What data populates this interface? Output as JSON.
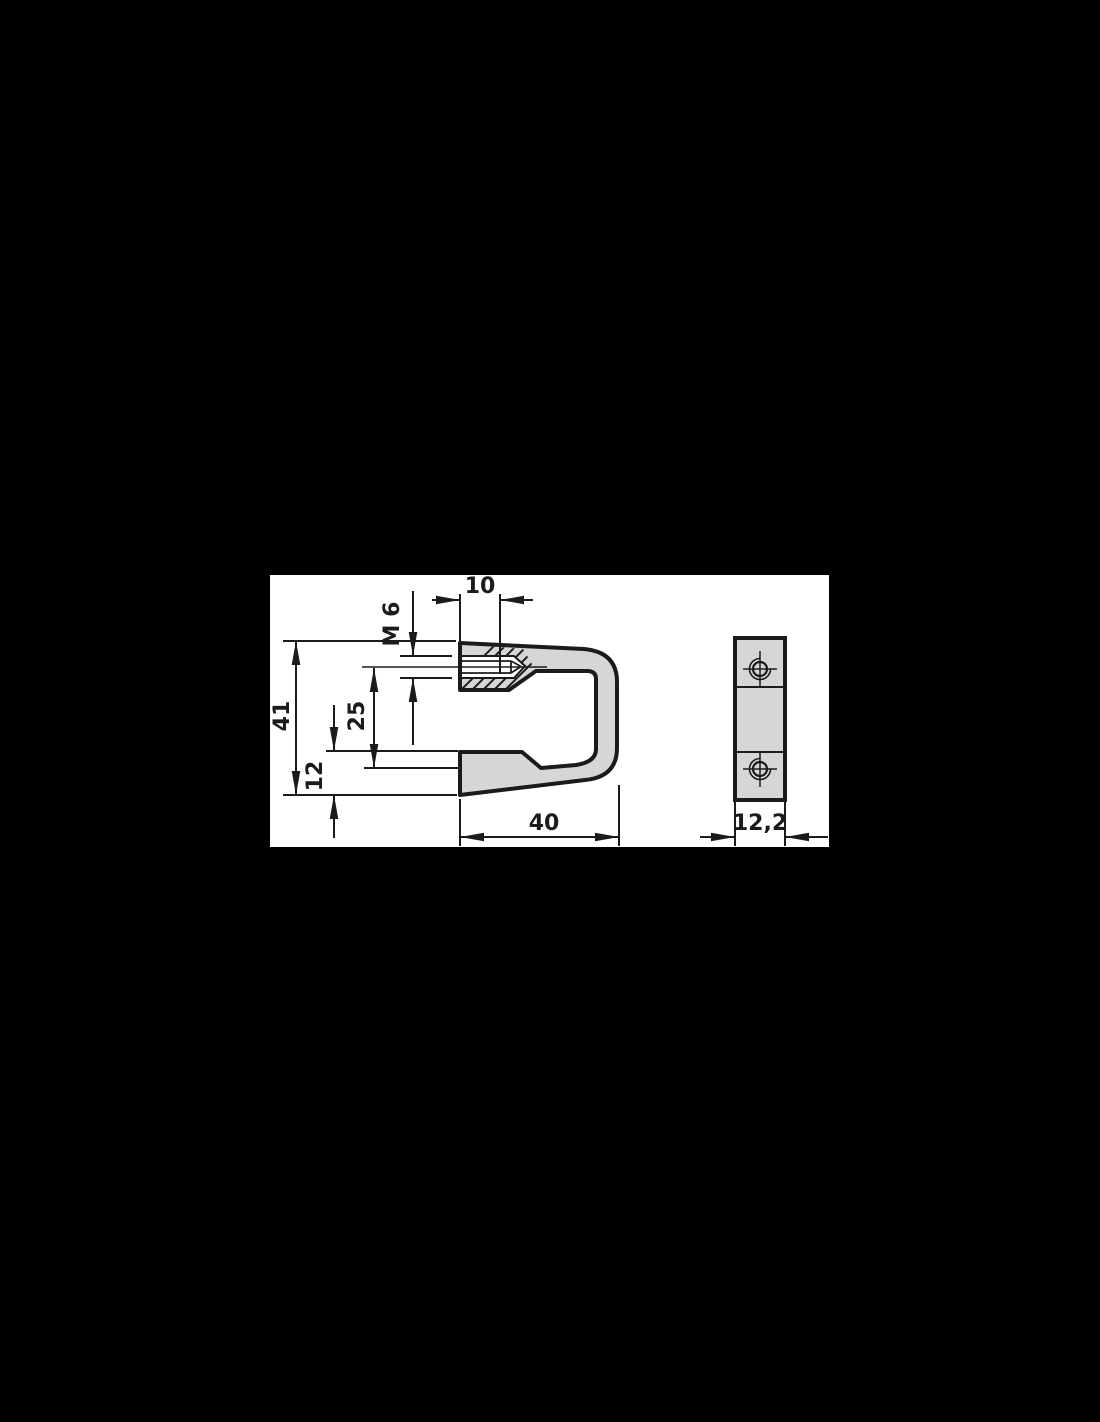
{
  "drawing": {
    "dimension_labels": {
      "hole_offset": "10",
      "thread": "M 6",
      "total_height": "41",
      "jaw_opening": "25",
      "base_thickness": "12",
      "width": "40",
      "depth": "12,2"
    },
    "colors": {
      "background": "#000000",
      "panel": "#ffffff",
      "part_fill": "#d6d6d8",
      "line": "#1b1b1b"
    }
  }
}
